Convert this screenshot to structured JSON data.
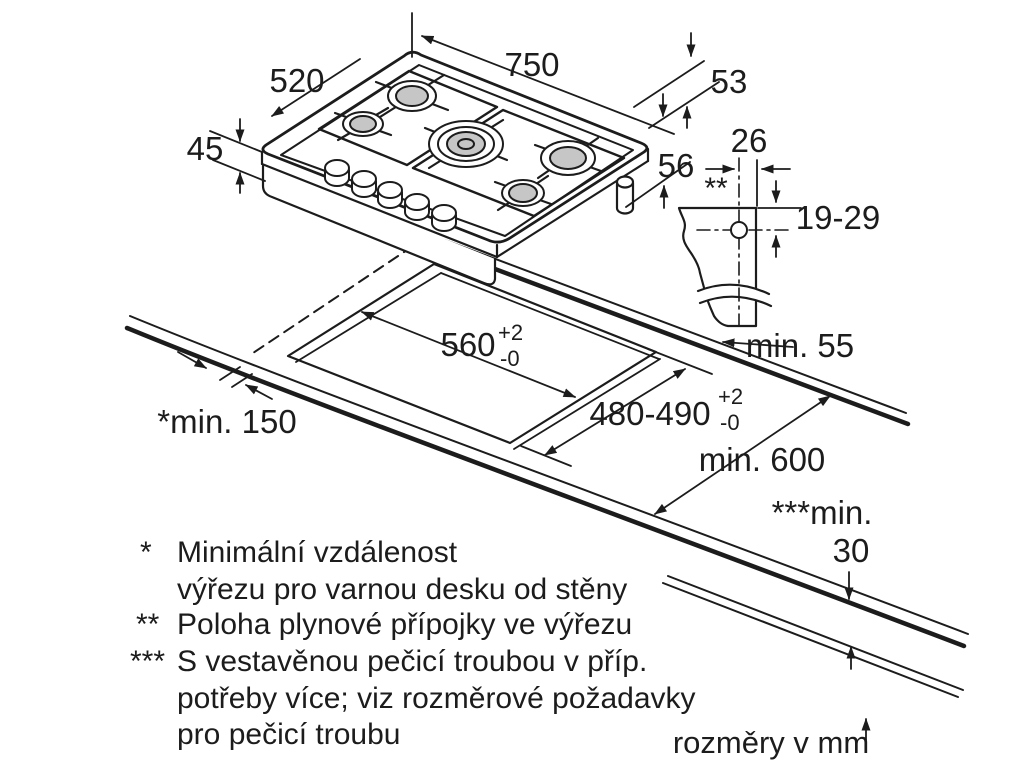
{
  "dims": {
    "hob_width": "750",
    "hob_depth": "520",
    "hob_height": "45",
    "gas_top_offset": "53",
    "gas_side_offset": "56",
    "gas_detail_width": "26",
    "gas_detail_depth": "19-29",
    "gas_detail_marker": "**",
    "cutout_width": "560",
    "cutout_width_tol_plus": "+2",
    "cutout_width_tol_minus": "-0",
    "cutout_depth": "480-490",
    "cutout_depth_tol_plus": "+2",
    "cutout_depth_tol_minus": "-0",
    "clearance_back": "min. 55",
    "clearance_left": "*min. 150",
    "worktop_depth": "min. 600",
    "clearance_below_label": "***min.",
    "clearance_below_value": "30"
  },
  "footnotes": [
    {
      "marker": "*",
      "lines": [
        "Minimální vzdálenost",
        "výřezu pro varnou desku od stěny"
      ]
    },
    {
      "marker": "**",
      "lines": [
        "Poloha plynové přípojky ve výřezu"
      ]
    },
    {
      "marker": "***",
      "lines": [
        "S vestavěnou pečicí troubou v příp.",
        "potřeby více; viz rozměrové požadavky",
        "pro pečicí troubu"
      ]
    }
  ],
  "units_note": "rozměry v mm",
  "colors": {
    "line": "#1c1c1c",
    "burner_cap": "#c6c6c6",
    "background": "#ffffff"
  }
}
